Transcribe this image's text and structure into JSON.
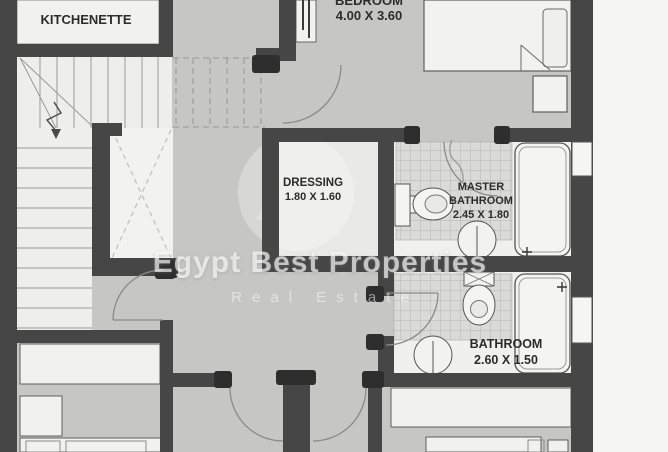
{
  "watermark": {
    "title": "Egypt Best Properties",
    "subtitle": "Real Estate"
  },
  "rooms": {
    "kitchenette": {
      "name": "KITCHENETTE"
    },
    "bedroom": {
      "name": "BEDROOM",
      "dimensions": "4.00 X 3.60"
    },
    "dressing": {
      "name": "DRESSING",
      "dimensions": "1.80 X 1.60"
    },
    "master_bathroom": {
      "name_line1": "MASTER",
      "name_line2": "BATHROOM",
      "dimensions": "2.45 X 1.80"
    },
    "bathroom": {
      "name": "BATHROOM",
      "dimensions": "2.60 X 1.50"
    }
  },
  "colors": {
    "wall": "#464646",
    "hall_floor": "#c6c6c5",
    "room_floor": "#f0f0ee",
    "tile": "#dadad8",
    "outside": "#f5f5f3",
    "watermark": "#ffffff"
  }
}
